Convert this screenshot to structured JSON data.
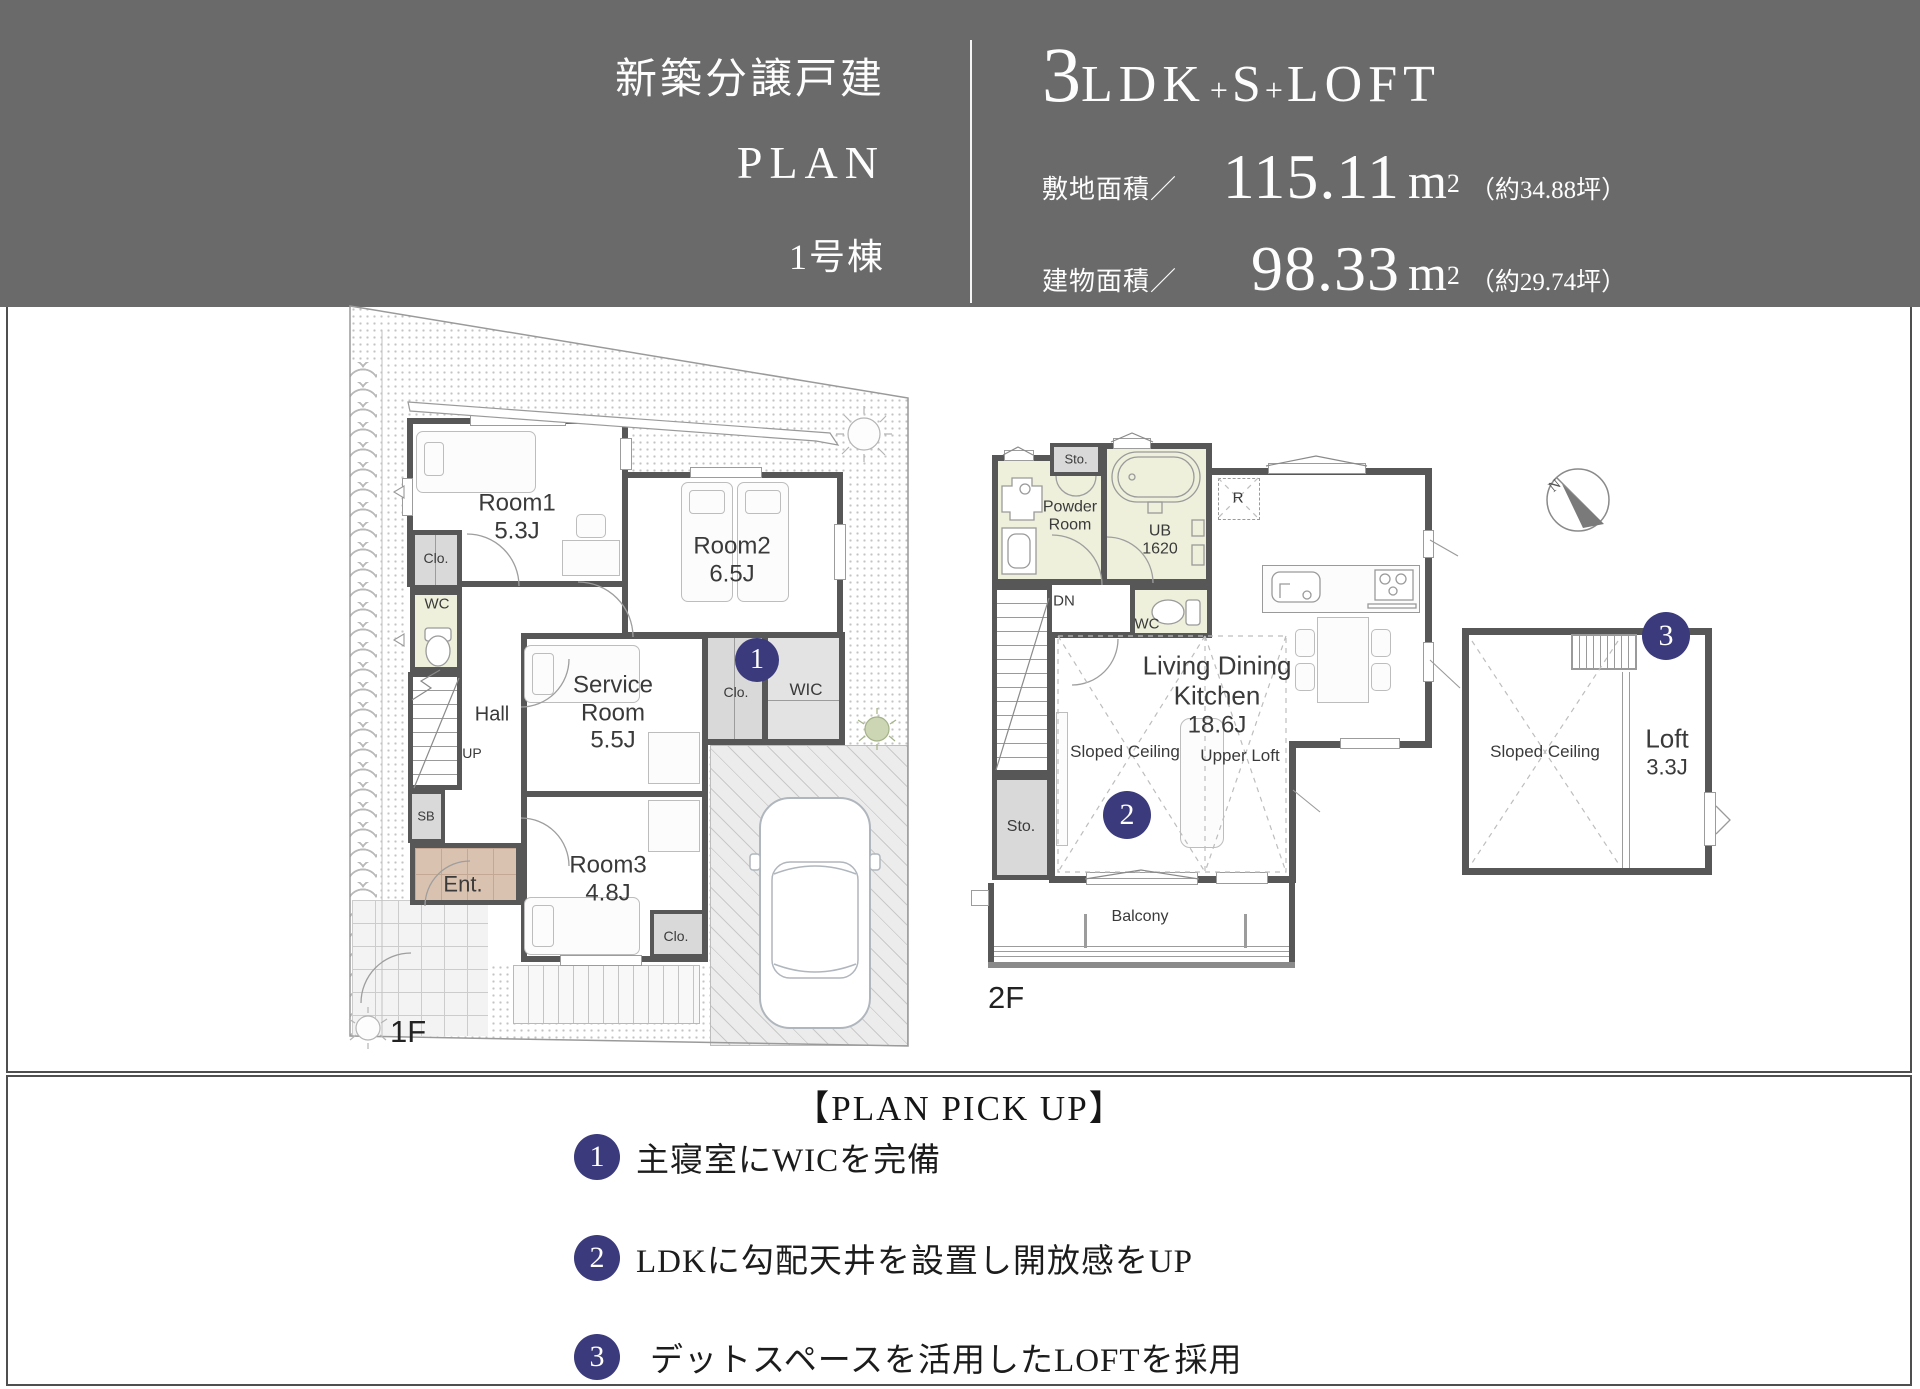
{
  "header": {
    "project_type": "新築分譲戸建",
    "plan_word": "PLAN",
    "building_no": "1号棟",
    "layout": {
      "num": "3",
      "seg1": "LDK",
      "plus1": "+",
      "seg2": "S",
      "plus2": "+",
      "seg3": "LOFT"
    },
    "rows": [
      {
        "label": "敷地面積／",
        "value": "115.11",
        "unit": "m",
        "sup": "2",
        "paren": "（約34.88坪）"
      },
      {
        "label": "建物面積／",
        "value": "98.33",
        "unit": "m",
        "sup": "2",
        "paren": "（約29.74坪）"
      }
    ]
  },
  "floor1": {
    "floor_label": "1F",
    "room1_name": "Room1",
    "room1_size": "5.3J",
    "room2_name": "Room2",
    "room2_size": "6.5J",
    "service_line1": "Service",
    "service_line2": "Room",
    "service_size": "5.5J",
    "room3_name": "Room3",
    "room3_size": "4.8J",
    "closet1": "Clo.",
    "closet3": "Clo.",
    "wic_closet": "Clo.",
    "wic": "WIC",
    "wc": "WC",
    "hall": "Hall",
    "up": "UP",
    "sb": "SB",
    "ent": "Ent.",
    "badge": "1"
  },
  "floor2": {
    "floor_label": "2F",
    "sto_top": "Sto.",
    "sto_bottom": "Sto.",
    "powder_line1": "Powder",
    "powder_line2": "Room",
    "ub_line1": "UB",
    "ub_line2": "1620",
    "wc": "WC",
    "dn": "DN",
    "fridge": "R",
    "ldk_line1": "Living Dining",
    "ldk_line2": "Kitchen",
    "ldk_size": "18.6J",
    "sloped": "Sloped Ceiling",
    "upper_loft": "Upper Loft",
    "balcony": "Balcony",
    "badge": "2"
  },
  "loft": {
    "sloped": "Sloped Ceiling",
    "name": "Loft",
    "size": "3.3J",
    "compass_n": "N",
    "badge": "3"
  },
  "pickup": {
    "title": "【PLAN PICK UP】",
    "items": [
      {
        "num": "1",
        "text": "主寝室にWICを完備"
      },
      {
        "num": "2",
        "text": "LDKに勾配天井を設置し開放感をUP"
      },
      {
        "num": "3",
        "text": "デットスペースを活用したLOFTを採用"
      }
    ]
  },
  "colors": {
    "header_bg": "#6a6a6a",
    "accent_navy": "#3a3a7c",
    "wall": "#575757",
    "wet_area": "#eef0dc",
    "closet_gray": "#d9d9d9",
    "entrance_brown": "#d9c2b0"
  }
}
